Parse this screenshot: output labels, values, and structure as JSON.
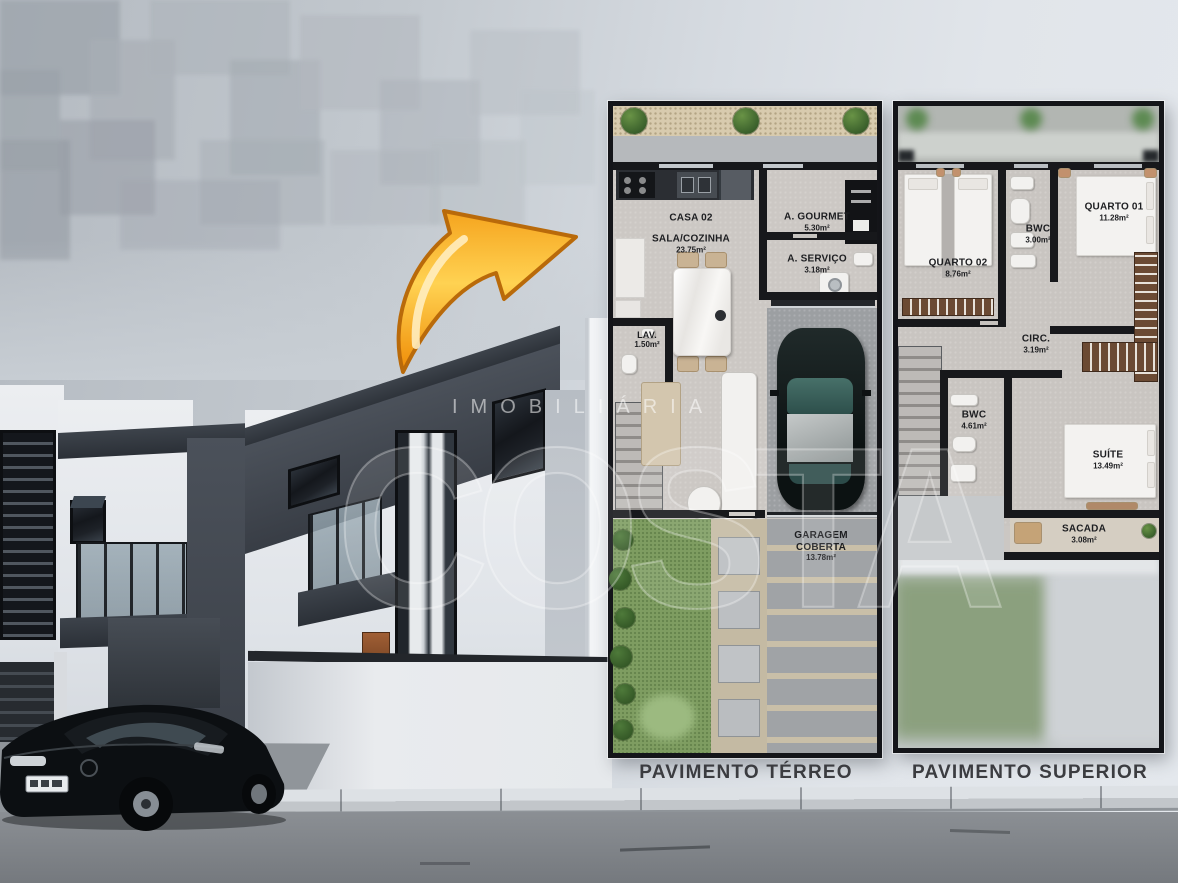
{
  "floor_plans": {
    "terreo": {
      "caption": "PAVIMENTO TÉRREO",
      "unit": "CASA 02",
      "rooms": [
        {
          "name": "SALA/COZINHA",
          "area": "23.75m²"
        },
        {
          "name": "A. GOURMET",
          "area": "5.30m²"
        },
        {
          "name": "A. SERVIÇO",
          "area": "3.18m²"
        },
        {
          "name": "LAV.",
          "area": "1.50m²"
        },
        {
          "name": "GARAGEM COBERTA",
          "area": "13.78m²"
        }
      ]
    },
    "superior": {
      "caption": "PAVIMENTO SUPERIOR",
      "rooms": [
        {
          "name": "QUARTO 02",
          "area": "8.76m²"
        },
        {
          "name": "BWC",
          "area": "3.00m²"
        },
        {
          "name": "QUARTO 01",
          "area": "11.28m²"
        },
        {
          "name": "CIRC.",
          "area": "3.19m²"
        },
        {
          "name": "BWC",
          "area": "4.61m²"
        },
        {
          "name": "SUÍTE",
          "area": "13.49m²"
        },
        {
          "name": "SACADA",
          "area": "3.08m²"
        }
      ]
    }
  },
  "watermark": {
    "brand_line": "IMOBILIÁRIA",
    "brand_main": "COSTA"
  },
  "colors": {
    "arrow_orange": "#F7A21B",
    "plan_wall": "#17181B",
    "garden_green": "#7E9D61",
    "charcoal_facade": "#41464E",
    "sky_light": "#DDE2E8"
  }
}
